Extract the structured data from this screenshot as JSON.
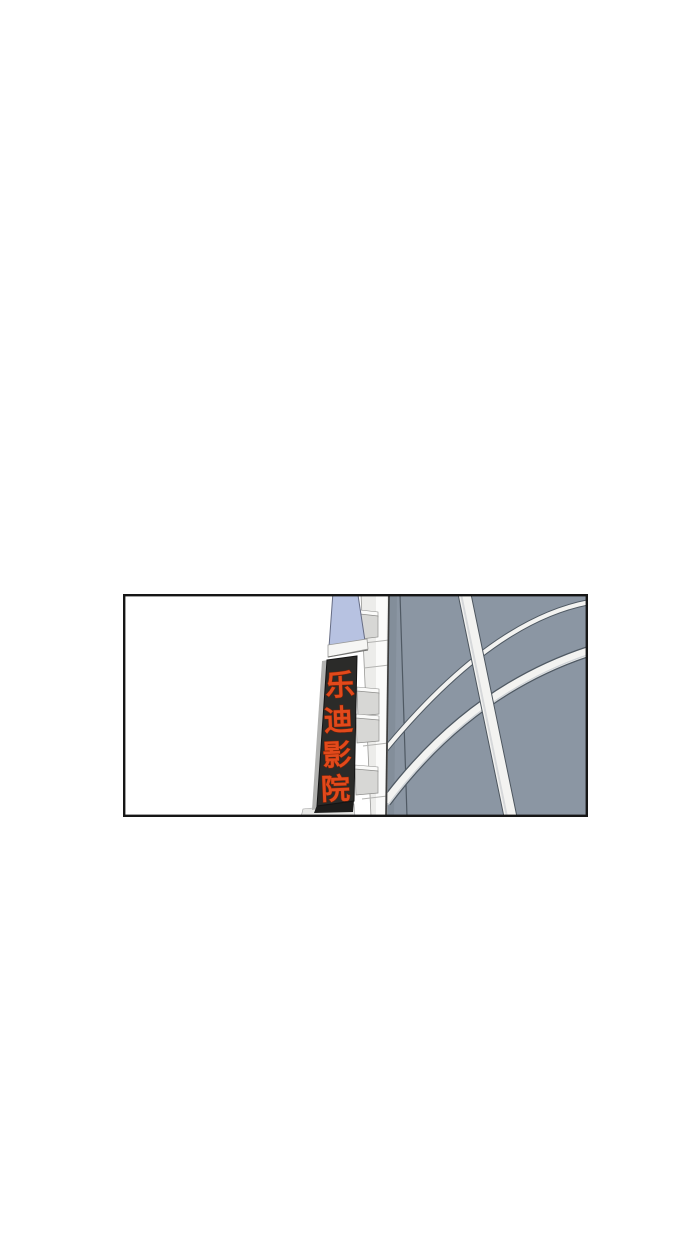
{
  "panel": {
    "sign": {
      "text": "乐迪影院",
      "characters": [
        "乐",
        "迪",
        "影",
        "院"
      ],
      "text_color": "#e2491b",
      "panel_color": "#2b2b29"
    },
    "colors": {
      "page_background": "#ffffff",
      "panel_border": "#161616",
      "facade": "#8b96a3",
      "facade_shadow": "#7d8894",
      "canopy_glass": "#b7c2e1",
      "structure_white": "#f3f3f1",
      "bracket": "#d7d7d5",
      "outline": "#4f5963"
    }
  }
}
